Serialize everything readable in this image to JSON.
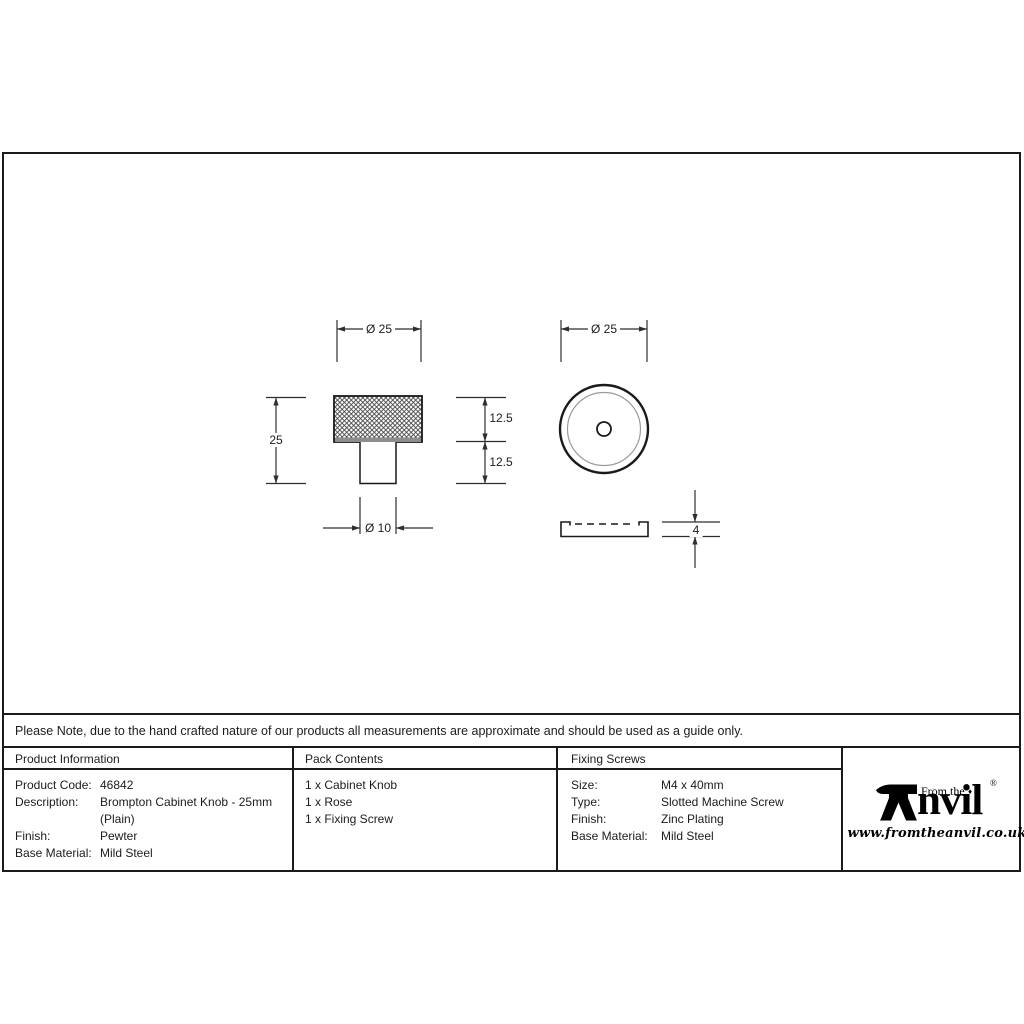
{
  "note": "Please Note, due to the hand crafted nature of our products all measurements are approximate and should be used as a guide only.",
  "drawing": {
    "front_view": {
      "diameter_top": "Ø 25",
      "overall_height": "25",
      "head_height": "12.5",
      "stem_height": "12.5",
      "stem_diameter": "Ø 10"
    },
    "top_view": {
      "diameter": "Ø 25"
    },
    "side_view": {
      "rose_thickness": "4"
    }
  },
  "table": {
    "product_information": {
      "title": "Product Information",
      "rows": [
        {
          "label": "Product Code:",
          "value": "46842"
        },
        {
          "label": "Description:",
          "value": "Brompton Cabinet Knob - 25mm"
        },
        {
          "label": "",
          "value": "(Plain)"
        },
        {
          "label": "Finish:",
          "value": "Pewter"
        },
        {
          "label": "Base Material:",
          "value": "Mild Steel"
        }
      ]
    },
    "pack_contents": {
      "title": "Pack Contents",
      "items": [
        "1 x Cabinet Knob",
        "1 x Rose",
        "1 x Fixing Screw"
      ]
    },
    "fixing_screws": {
      "title": "Fixing Screws",
      "rows": [
        {
          "label": "Size:",
          "value": "M4 x 40mm"
        },
        {
          "label": "Type:",
          "value": "Slotted Machine Screw"
        },
        {
          "label": "Finish:",
          "value": "Zinc Plating"
        },
        {
          "label": "Base Material:",
          "value": "Mild Steel"
        }
      ]
    }
  },
  "logo": {
    "prefix": "From the",
    "name": "Anvil",
    "name_rest": "nvil",
    "diamond": "♦",
    "registered": "®",
    "url": "www.fromtheanvil.co.uk",
    "color": "#000000"
  }
}
